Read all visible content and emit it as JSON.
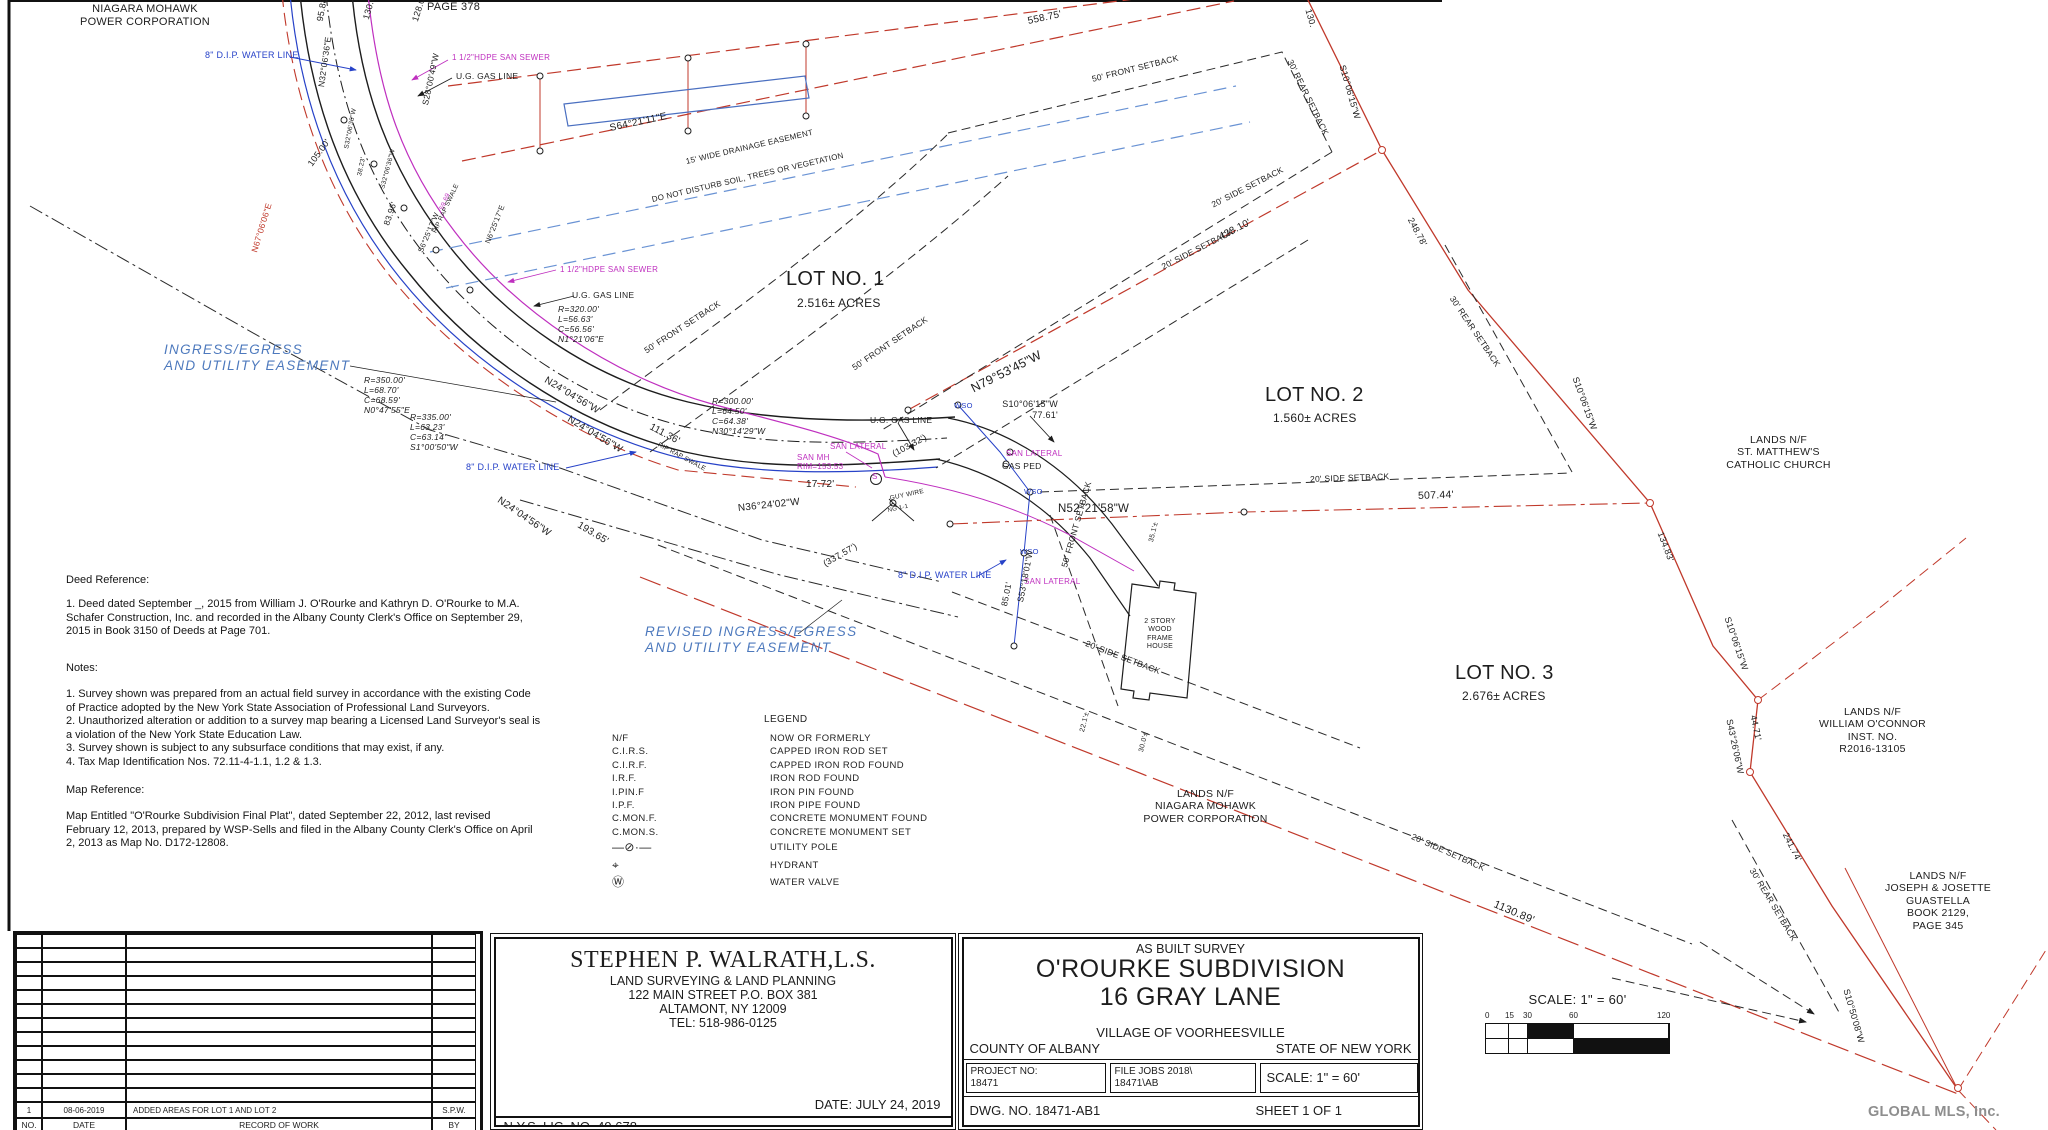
{
  "page": {
    "watermark": "GLOBAL MLS, Inc."
  },
  "map": {
    "labels": [
      {
        "t": "NIAGARA MOHAWK\nPOWER CORPORATION",
        "x": 75,
        "y": 3,
        "s": 11,
        "c": "k",
        "a": "c",
        "w": 140
      },
      {
        "t": "PAGE 378",
        "x": 427,
        "y": 1,
        "s": 11,
        "c": "k"
      },
      {
        "t": "8\" D.I.P. WATER LINE",
        "x": 205,
        "y": 50,
        "s": 9,
        "c": "b"
      },
      {
        "t": "1 1/2\"HDPE SAN SEWER",
        "x": 452,
        "y": 53,
        "s": 8,
        "c": "m"
      },
      {
        "t": "U.G. GAS LINE",
        "x": 456,
        "y": 71,
        "s": 8.5,
        "c": "k"
      },
      {
        "t": "95.88'",
        "x": 320,
        "y": 16,
        "r": -80,
        "s": 9,
        "c": "k"
      },
      {
        "t": "130.69'",
        "x": 366,
        "y": 14,
        "r": -74,
        "s": 9,
        "c": "k"
      },
      {
        "t": "128.05'",
        "x": 415,
        "y": 16,
        "r": -72,
        "s": 9,
        "c": "k"
      },
      {
        "t": "N32°06'36\"E",
        "x": 321,
        "y": 82,
        "r": -82,
        "s": 8.5,
        "c": "k"
      },
      {
        "t": "S28°00'49\"W",
        "x": 425,
        "y": 100,
        "r": -78,
        "s": 8.5,
        "c": "k"
      },
      {
        "t": "105.00'",
        "x": 310,
        "y": 160,
        "r": -54,
        "s": 9,
        "c": "k"
      },
      {
        "t": "S32°06'36\"W",
        "x": 347,
        "y": 145,
        "r": -79,
        "s": 6.5,
        "c": "k"
      },
      {
        "t": "38.23'",
        "x": 360,
        "y": 172,
        "r": -78,
        "s": 6.5,
        "c": "k"
      },
      {
        "t": "S32°06'36\"W",
        "x": 383,
        "y": 185,
        "r": -75,
        "s": 6.5,
        "c": "k"
      },
      {
        "t": "83.96'",
        "x": 386,
        "y": 220,
        "r": -71,
        "s": 8.5,
        "c": "k"
      },
      {
        "t": "N67°06'06\"E",
        "x": 254,
        "y": 247,
        "r": -73,
        "s": 8.5,
        "c": "r"
      },
      {
        "t": "59.69",
        "x": 442,
        "y": 206,
        "r": -67,
        "s": 6.5,
        "c": "m"
      },
      {
        "t": "RIP RAP SWALE",
        "x": 435,
        "y": 229,
        "r": -65,
        "s": 6.5,
        "c": "k"
      },
      {
        "t": "S6°25'17\"W",
        "x": 421,
        "y": 248,
        "r": -67,
        "s": 7.5,
        "c": "k"
      },
      {
        "t": "N6°25'17\"E",
        "x": 488,
        "y": 239,
        "r": -68,
        "s": 7.5,
        "c": "k"
      },
      {
        "t": "558.75'",
        "x": 1028,
        "y": 16,
        "r": -12,
        "s": 10,
        "c": "k"
      },
      {
        "t": "S64°21'11\"E",
        "x": 610,
        "y": 123,
        "r": -12,
        "s": 10,
        "c": "k"
      },
      {
        "t": "15' WIDE DRAINAGE EASEMENT",
        "x": 686,
        "y": 157,
        "r": -13,
        "s": 8,
        "c": "k"
      },
      {
        "t": "DO NOT DISTURB SOIL, TREES OR VEGETATION",
        "x": 652,
        "y": 195,
        "r": -13,
        "s": 8,
        "c": "k"
      },
      {
        "t": "50' FRONT SETBACK",
        "x": 1092,
        "y": 74,
        "r": -14,
        "s": 8.5,
        "c": "k"
      },
      {
        "t": "30' REAR SETBACK",
        "x": 1290,
        "y": 55,
        "r": 64,
        "s": 8.5,
        "c": "k"
      },
      {
        "t": "130.",
        "x": 1308,
        "y": 4,
        "r": 74,
        "s": 9,
        "c": "k"
      },
      {
        "t": "S10°06'15\"W",
        "x": 1342,
        "y": 60,
        "r": 74,
        "s": 9,
        "c": "k"
      },
      {
        "t": "248.78'",
        "x": 1410,
        "y": 213,
        "r": 62,
        "s": 9,
        "c": "k"
      },
      {
        "t": "428.10'",
        "x": 1220,
        "y": 232,
        "r": -27,
        "s": 10,
        "c": "k"
      },
      {
        "t": "20' SIDE SETBACK",
        "x": 1212,
        "y": 200,
        "r": -27,
        "s": 8.5,
        "c": "k"
      },
      {
        "t": "20' SIDE SETBACK",
        "x": 1162,
        "y": 262,
        "r": -27,
        "s": 8.5,
        "c": "k"
      },
      {
        "t": "LOT NO. 1",
        "x": 786,
        "y": 268,
        "s": 20,
        "c": "k"
      },
      {
        "t": "2.516± ACRES",
        "x": 797,
        "y": 296,
        "s": 12,
        "c": "k"
      },
      {
        "t": "LOT NO. 2",
        "x": 1265,
        "y": 384,
        "s": 20,
        "c": "k"
      },
      {
        "t": "1.560± ACRES",
        "x": 1273,
        "y": 411,
        "s": 12,
        "c": "k"
      },
      {
        "t": "LOT NO. 3",
        "x": 1455,
        "y": 662,
        "s": 20,
        "c": "k"
      },
      {
        "t": "2.676± ACRES",
        "x": 1462,
        "y": 689,
        "s": 12,
        "c": "k"
      },
      {
        "t": "30' REAR SETBACK",
        "x": 1452,
        "y": 292,
        "r": 56,
        "s": 8.5,
        "c": "k"
      },
      {
        "t": "INGRESS/EGRESS\nAND UTILITY EASEMENT",
        "x": 164,
        "y": 342,
        "s": 13.5,
        "c": "e"
      },
      {
        "t": "REVISED INGRESS/EGRESS\nAND UTILITY EASEMENT",
        "x": 645,
        "y": 624,
        "s": 13.5,
        "c": "e"
      },
      {
        "t": "R=350.00'\nL=68.70'\nC=68.59'\nN0°47'55\"E",
        "x": 364,
        "y": 375,
        "s": 8.5,
        "c": "k",
        "i": 1
      },
      {
        "t": "R=335.00'\nL=63.23'\nC=63.14'\nS1°00'50\"W",
        "x": 410,
        "y": 412,
        "s": 8.5,
        "c": "k",
        "i": 1
      },
      {
        "t": "R=320.00'\nL=56.63'\nC=56.56'\nN1°21'06\"E",
        "x": 558,
        "y": 304,
        "s": 8.5,
        "c": "k",
        "i": 1
      },
      {
        "t": "R=300.00'\nL=64.50'\nC=64.38'\nN30°14'29\"W",
        "x": 712,
        "y": 396,
        "s": 8.5,
        "c": "k",
        "i": 1
      },
      {
        "t": "1 1/2\"HDPE SAN SEWER",
        "x": 560,
        "y": 265,
        "s": 8,
        "c": "m"
      },
      {
        "t": "U.G. GAS LINE",
        "x": 572,
        "y": 290,
        "s": 8.5,
        "c": "k"
      },
      {
        "t": "50' FRONT SETBACK",
        "x": 645,
        "y": 346,
        "r": -33,
        "s": 8.5,
        "c": "k"
      },
      {
        "t": "N24°04'56\"W",
        "x": 545,
        "y": 374,
        "r": 31,
        "s": 10,
        "c": "k"
      },
      {
        "t": "N24°04'56\"W",
        "x": 568,
        "y": 413,
        "r": 31,
        "s": 10,
        "c": "k"
      },
      {
        "t": "111.36'",
        "x": 650,
        "y": 421,
        "r": 28,
        "s": 10,
        "c": "k"
      },
      {
        "t": "RIP RAP SWALE",
        "x": 658,
        "y": 441,
        "r": 28,
        "s": 6.5,
        "c": "k"
      },
      {
        "t": "N24°04'56\"W",
        "x": 498,
        "y": 494,
        "r": 34,
        "s": 10,
        "c": "k"
      },
      {
        "t": "193.65'",
        "x": 578,
        "y": 519,
        "r": 31,
        "s": 10,
        "c": "k"
      },
      {
        "t": "8\" D.I.P. WATER LINE",
        "x": 466,
        "y": 462,
        "s": 9,
        "c": "b"
      },
      {
        "t": "(337.57')",
        "x": 824,
        "y": 559,
        "r": -30,
        "s": 9,
        "c": "k"
      },
      {
        "t": "17.72'",
        "x": 806,
        "y": 479,
        "s": 10,
        "c": "k"
      },
      {
        "t": "N36°24'02\"W",
        "x": 738,
        "y": 503,
        "r": -6,
        "s": 10,
        "c": "k"
      },
      {
        "t": "(103.32')",
        "x": 893,
        "y": 449,
        "r": -28,
        "s": 9,
        "c": "k"
      },
      {
        "t": "SAN LATERAL",
        "x": 830,
        "y": 442,
        "s": 8,
        "c": "m"
      },
      {
        "t": "SAN MH\nRIM=153.53",
        "x": 797,
        "y": 453,
        "s": 8,
        "c": "m"
      },
      {
        "t": "S",
        "x": 872,
        "y": 472,
        "s": 8,
        "c": "m"
      },
      {
        "t": "U.G. GAS LINE",
        "x": 870,
        "y": 415,
        "s": 8.5,
        "c": "k"
      },
      {
        "t": "50' FRONT SETBACK",
        "x": 853,
        "y": 363,
        "r": -34,
        "s": 8.5,
        "c": "k"
      },
      {
        "t": "WSO",
        "x": 954,
        "y": 402,
        "s": 7.5,
        "c": "b"
      },
      {
        "t": "N79°53'45\"W",
        "x": 972,
        "y": 382,
        "r": -27,
        "s": 12.5,
        "c": "k"
      },
      {
        "t": "S10°06'15\"W\n77.61'",
        "x": 996,
        "y": 399,
        "s": 9,
        "c": "k",
        "a": "r",
        "w": 62
      },
      {
        "t": "SAN LATERAL",
        "x": 1006,
        "y": 449,
        "s": 8,
        "c": "m"
      },
      {
        "t": "GAS PED",
        "x": 1002,
        "y": 461,
        "s": 8.5,
        "c": "k"
      },
      {
        "t": "WSO",
        "x": 1024,
        "y": 488,
        "s": 7.5,
        "c": "b"
      },
      {
        "t": "N52°21'58\"W",
        "x": 1058,
        "y": 503,
        "s": 11.5,
        "c": "k"
      },
      {
        "t": "GUY WIRE",
        "x": 890,
        "y": 495,
        "r": -12,
        "s": 6.5,
        "c": "k"
      },
      {
        "t": "NG 1-1",
        "x": 888,
        "y": 508,
        "r": -12,
        "s": 6,
        "c": "k"
      },
      {
        "t": "20' SIDE SETBACK",
        "x": 1310,
        "y": 474,
        "r": -2,
        "s": 8.5,
        "c": "k"
      },
      {
        "t": "507.44'",
        "x": 1418,
        "y": 490,
        "r": -2,
        "s": 10.5,
        "c": "k"
      },
      {
        "t": "S10°06'15\"W",
        "x": 1575,
        "y": 372,
        "r": 70,
        "s": 9,
        "c": "k"
      },
      {
        "t": "WSO",
        "x": 1020,
        "y": 548,
        "s": 7.5,
        "c": "b"
      },
      {
        "t": "8\" D.I.P. WATER LINE",
        "x": 898,
        "y": 570,
        "s": 9,
        "c": "b"
      },
      {
        "t": "SAN LATERAL",
        "x": 1024,
        "y": 577,
        "s": 8,
        "c": "m"
      },
      {
        "t": "85.01'",
        "x": 1004,
        "y": 601,
        "r": -79,
        "s": 8.5,
        "c": "k"
      },
      {
        "t": "S53°18'01\"W",
        "x": 1020,
        "y": 597,
        "r": -79,
        "s": 8.5,
        "c": "k"
      },
      {
        "t": "50' FRONT SETBACK",
        "x": 1064,
        "y": 562,
        "r": -74,
        "s": 8.5,
        "c": "k"
      },
      {
        "t": "2 STORY\nWOOD\nFRAME\nHOUSE",
        "x": 1128,
        "y": 618,
        "s": 7,
        "c": "k",
        "a": "c",
        "w": 64
      },
      {
        "t": "35.1'±",
        "x": 1152,
        "y": 538,
        "r": -76,
        "s": 7,
        "c": "k"
      },
      {
        "t": "22.1'±",
        "x": 1083,
        "y": 728,
        "r": -76,
        "s": 7,
        "c": "k"
      },
      {
        "t": "30.0'±",
        "x": 1142,
        "y": 748,
        "r": -76,
        "s": 7,
        "c": "k"
      },
      {
        "t": "LANDS N/F\nNIAGARA MOHAWK\nPOWER CORPORATION",
        "x": 1118,
        "y": 788,
        "s": 10.5,
        "c": "k",
        "a": "c",
        "w": 175
      },
      {
        "t": "LANDS N/F\nST. MATTHEW'S\nCATHOLIC CHURCH",
        "x": 1706,
        "y": 434,
        "s": 10.5,
        "c": "k",
        "a": "c",
        "w": 145
      },
      {
        "t": "134.83'",
        "x": 1660,
        "y": 527,
        "r": 69,
        "s": 9,
        "c": "k"
      },
      {
        "t": "S10°06'15\"W",
        "x": 1727,
        "y": 612,
        "r": 71,
        "s": 9,
        "c": "k"
      },
      {
        "t": "S43°26'06\"W",
        "x": 1729,
        "y": 714,
        "r": 78,
        "s": 9,
        "c": "k"
      },
      {
        "t": "44.71'",
        "x": 1753,
        "y": 710,
        "r": 78,
        "s": 9,
        "c": "k"
      },
      {
        "t": "LANDS N/F\nWILLIAM O'CONNOR\nINST. NO.\nR2016-13105",
        "x": 1800,
        "y": 706,
        "s": 10.5,
        "c": "k",
        "a": "c",
        "w": 145
      },
      {
        "t": "241.74'",
        "x": 1785,
        "y": 828,
        "r": 63,
        "s": 9,
        "c": "k"
      },
      {
        "t": "1130.89'",
        "x": 1494,
        "y": 898,
        "r": 23,
        "s": 11,
        "c": "k"
      },
      {
        "t": "20' SIDE SETBACK",
        "x": 1412,
        "y": 831,
        "r": 24,
        "s": 8.5,
        "c": "k"
      },
      {
        "t": "30' REAR SETBACK",
        "x": 1752,
        "y": 864,
        "r": 59,
        "s": 8.5,
        "c": "k"
      },
      {
        "t": "20' SIDE SETBACK",
        "x": 1086,
        "y": 638,
        "r": 21,
        "s": 8.5,
        "c": "k"
      },
      {
        "t": "LANDS N/F\nJOSEPH & JOSETTE\nGUASTELLA\nBOOK 2129,\nPAGE 345",
        "x": 1858,
        "y": 870,
        "s": 10.5,
        "c": "k",
        "a": "c",
        "w": 160
      },
      {
        "t": "S10°50'08\"W",
        "x": 1846,
        "y": 984,
        "r": 74,
        "s": 9,
        "c": "k"
      }
    ]
  },
  "textblocks": {
    "deed_title": "Deed Reference:",
    "deed_body": "1. Deed dated September _, 2015 from William J. O'Rourke and Kathryn D. O'Rourke to M.A.\nSchafer Construction, Inc. and recorded in the Albany County Clerk's Office on September 29,\n2015 in Book 3150 of Deeds at Page 701.",
    "notes_title": "Notes:",
    "notes_body": "1. Survey shown was prepared from an actual field survey in accordance with the existing Code\nof Practice adopted by the New York State Association of Professional Land Surveyors.\n2. Unauthorized alteration or addition to a survey map bearing a Licensed Land Surveyor's seal is\na violation of the New York State Education Law.\n3. Survey shown is subject to any subsurface conditions that may exist, if any.\n4. Tax Map Identification Nos. 72.11-4-1.1, 1.2 & 1.3.",
    "mapref_title": "Map Reference:",
    "mapref_body": "Map Entitled \"O'Rourke Subdivision Final Plat\", dated September 22, 2012, last revised\nFebruary 12, 2013, prepared by WSP-Sells and filed in the Albany County Clerk's Office on April\n2, 2013 as Map No. D172-12808."
  },
  "legend": {
    "title": "LEGEND",
    "abbreviations": [
      {
        "abbr": "N/F",
        "meaning": "NOW OR FORMERLY"
      },
      {
        "abbr": "C.I.R.S.",
        "meaning": "CAPPED IRON ROD SET"
      },
      {
        "abbr": "C.I.R.F.",
        "meaning": "CAPPED IRON ROD FOUND"
      },
      {
        "abbr": "I.R.F.",
        "meaning": "IRON ROD FOUND"
      },
      {
        "abbr": "I.PIN.F",
        "meaning": "IRON PIN FOUND"
      },
      {
        "abbr": "I.P.F.",
        "meaning": "IRON PIPE FOUND"
      },
      {
        "abbr": "C.MON.F.",
        "meaning": "CONCRETE MONUMENT FOUND"
      },
      {
        "abbr": "C.MON.S.",
        "meaning": "CONCRETE MONUMENT SET"
      }
    ],
    "symbols": [
      {
        "glyph": "—⊘·—",
        "icon": "utility-pole-icon",
        "meaning": "UTILITY POLE"
      },
      {
        "glyph": "⌖",
        "icon": "hydrant-icon",
        "meaning": "HYDRANT"
      },
      {
        "glyph": "Ⓦ",
        "icon": "water-valve-icon",
        "meaning": "WATER VALVE"
      }
    ]
  },
  "revision_table": {
    "empty_row_count": 12,
    "entries": [
      {
        "no": "1",
        "date": "08-06-2019",
        "description": "ADDED AREAS FOR LOT 1 AND LOT 2",
        "by": "S.P.W."
      }
    ],
    "header": {
      "no": "NO.",
      "date": "DATE",
      "description": "RECORD OF WORK",
      "by": "BY"
    }
  },
  "firm_block": {
    "name": "STEPHEN P. WALRATH,L.S.",
    "line1": "LAND SURVEYING & LAND PLANNING",
    "line2": "122 MAIN STREET P.O. BOX 381",
    "line3": "ALTAMONT, NY 12009",
    "line4": "TEL: 518-986-0125",
    "date": "DATE: JULY 24, 2019",
    "license": "N.Y.S. LIC. NO. 49,678"
  },
  "project_block": {
    "survey_type": "AS BUILT SURVEY",
    "title1": "O'ROURKE SUBDIVISION",
    "title2": "16 GRAY LANE",
    "village": "VILLAGE OF VOORHEESVILLE",
    "county": "COUNTY OF ALBANY",
    "state": "STATE OF NEW YORK",
    "project_no_label": "PROJECT NO:",
    "project_no": "18471",
    "file_label": "FILE JOBS 2018\\",
    "file_no": "18471\\AB",
    "scale": "SCALE: 1\" = 60'",
    "dwg_no": "DWG. NO. 18471-AB1",
    "sheet": "SHEET 1 OF 1"
  },
  "scale_bar": {
    "caption": "SCALE: 1\" = 60'",
    "ticks": [
      {
        "label": "0",
        "x": 0
      },
      {
        "label": "15",
        "x": 20
      },
      {
        "label": "30",
        "x": 38
      },
      {
        "label": "60",
        "x": 84
      },
      {
        "label": "120",
        "x": 172
      }
    ],
    "segments_top": [
      {
        "w": 23,
        "f": "w"
      },
      {
        "w": 19,
        "f": "w"
      },
      {
        "w": 46,
        "f": "b"
      },
      {
        "w": 95,
        "f": "w"
      }
    ],
    "segments_bottom": [
      {
        "w": 23,
        "f": "w"
      },
      {
        "w": 19,
        "f": "w"
      },
      {
        "w": 46,
        "f": "w"
      },
      {
        "w": 95,
        "f": "b"
      }
    ]
  }
}
